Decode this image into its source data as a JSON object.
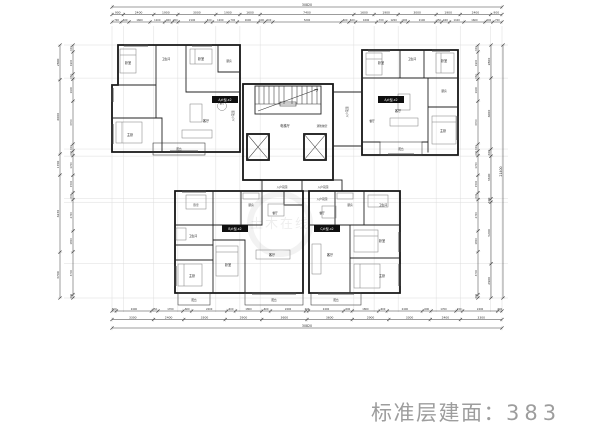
{
  "meta": {
    "title_label": "标准层建面：",
    "title_value": "383"
  },
  "watermark": {
    "text": "土木在线"
  },
  "units": {
    "top_left": "A户型-x2",
    "top_right": "A户型-x2",
    "bottom_left": "B户型-x2",
    "bottom_right": "C户型-x2"
  },
  "rooms": {
    "bedroom": "卧室",
    "master": "主卧",
    "living": "客厅",
    "dining": "餐厅",
    "kitchen": "厨房",
    "bath": "卫生间",
    "balcony": "阳台",
    "entry_garden": "入户花园",
    "elevator_hall": "电梯厅",
    "fire_lobby": "消防前室"
  },
  "dimensions": {
    "top_total": [
      30820
    ],
    "top_major": [
      900,
      2400,
      1900,
      3000,
      1900,
      1600,
      7400,
      1600,
      1900,
      3000,
      1900,
      2400,
      900
    ],
    "top_minor": [
      700,
      600,
      1600,
      1100,
      600,
      450,
      2100,
      500,
      1200,
      700,
      1600,
      500,
      600,
      5200,
      600,
      500,
      1600,
      700,
      1200,
      500,
      2100,
      450,
      600,
      1100,
      1600,
      600,
      700
    ],
    "bottom_minor": [
      300,
      2400,
      450,
      1700,
      600,
      2400,
      600,
      1800,
      600,
      2400,
      200,
      2400,
      600,
      1800,
      600,
      2400,
      600,
      1700,
      450,
      2400,
      300
    ],
    "bottom_major": [
      3300,
      2400,
      3300,
      2900,
      3600,
      3600,
      2900,
      3300,
      2400,
      3300
    ],
    "bottom_total": [
      30820
    ],
    "left_outer": [
      2800,
      6000,
      1700,
      6230,
      3700
    ],
    "left_inner": [
      600,
      1900,
      450,
      1900,
      3700,
      600,
      400,
      1700,
      1500,
      600,
      2700,
      1800,
      3700,
      300
    ],
    "right_inner": [
      600,
      1900,
      450,
      1900,
      3700,
      600,
      400,
      1700,
      1500,
      600,
      2700,
      1800,
      3700,
      300
    ],
    "right_major": [
      2800,
      6000,
      600,
      3600,
      300,
      5200,
      2900
    ],
    "right_total": [
      21400
    ]
  }
}
